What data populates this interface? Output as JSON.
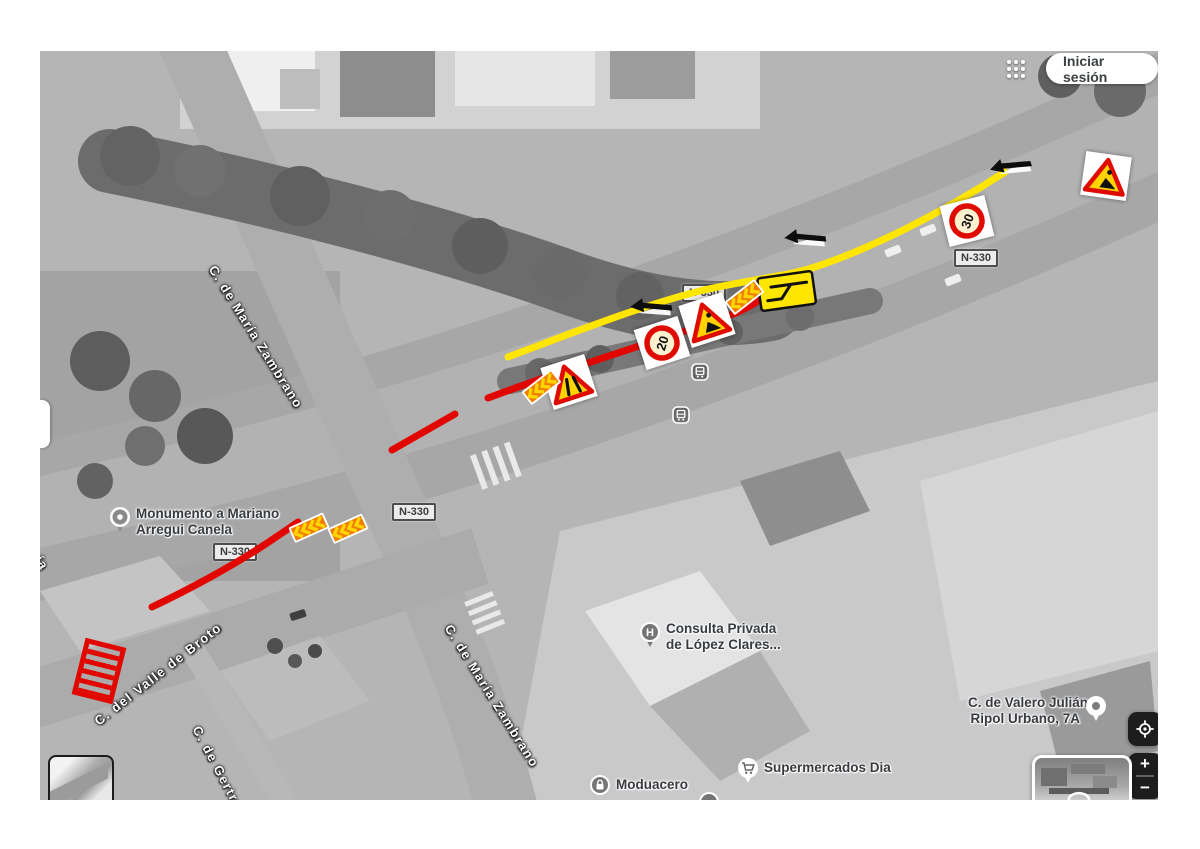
{
  "app": {
    "signin_label": "Iniciar sesión"
  },
  "overlay": {
    "road_badges": [
      {
        "text": "N-330"
      },
      {
        "text": "N-330"
      },
      {
        "text": "N-330"
      },
      {
        "text": "N-330"
      }
    ],
    "street_labels": [
      {
        "text": "C. de María Zambrano"
      },
      {
        "text": "C. de María Zambrano"
      },
      {
        "text": "C. del Valle de Broto"
      },
      {
        "text": "C. de Gertru"
      },
      {
        "text": "ía"
      }
    ],
    "pois": [
      {
        "line1": "Monumento a Mariano",
        "line2": "Arregui Canela",
        "icon": "monument-pin-icon"
      },
      {
        "line1": "Consulta Privada",
        "line2": "de López Clares...",
        "icon": "hospital-pin-icon"
      },
      {
        "line1": "C. de Valero Julián",
        "line2": "Ripol Urbano, 7A",
        "icon": "address-pin-icon"
      },
      {
        "line1": "Supermercados Dia",
        "icon": "shopping-cart-pin-icon"
      },
      {
        "line1": "Moduacero",
        "icon": "lock-pin-icon"
      }
    ],
    "signs": {
      "speed_30": "30",
      "speed_20": "20"
    },
    "colors": {
      "closure_red": "#e10600",
      "diversion_yellow": "#ffe600",
      "sign_warning_yellow": "#ffd200",
      "sign_ring_red": "#e00b00",
      "chevron_orange": "#f07d00"
    }
  },
  "controls": {
    "zoom_in": "+",
    "zoom_out": "−"
  }
}
